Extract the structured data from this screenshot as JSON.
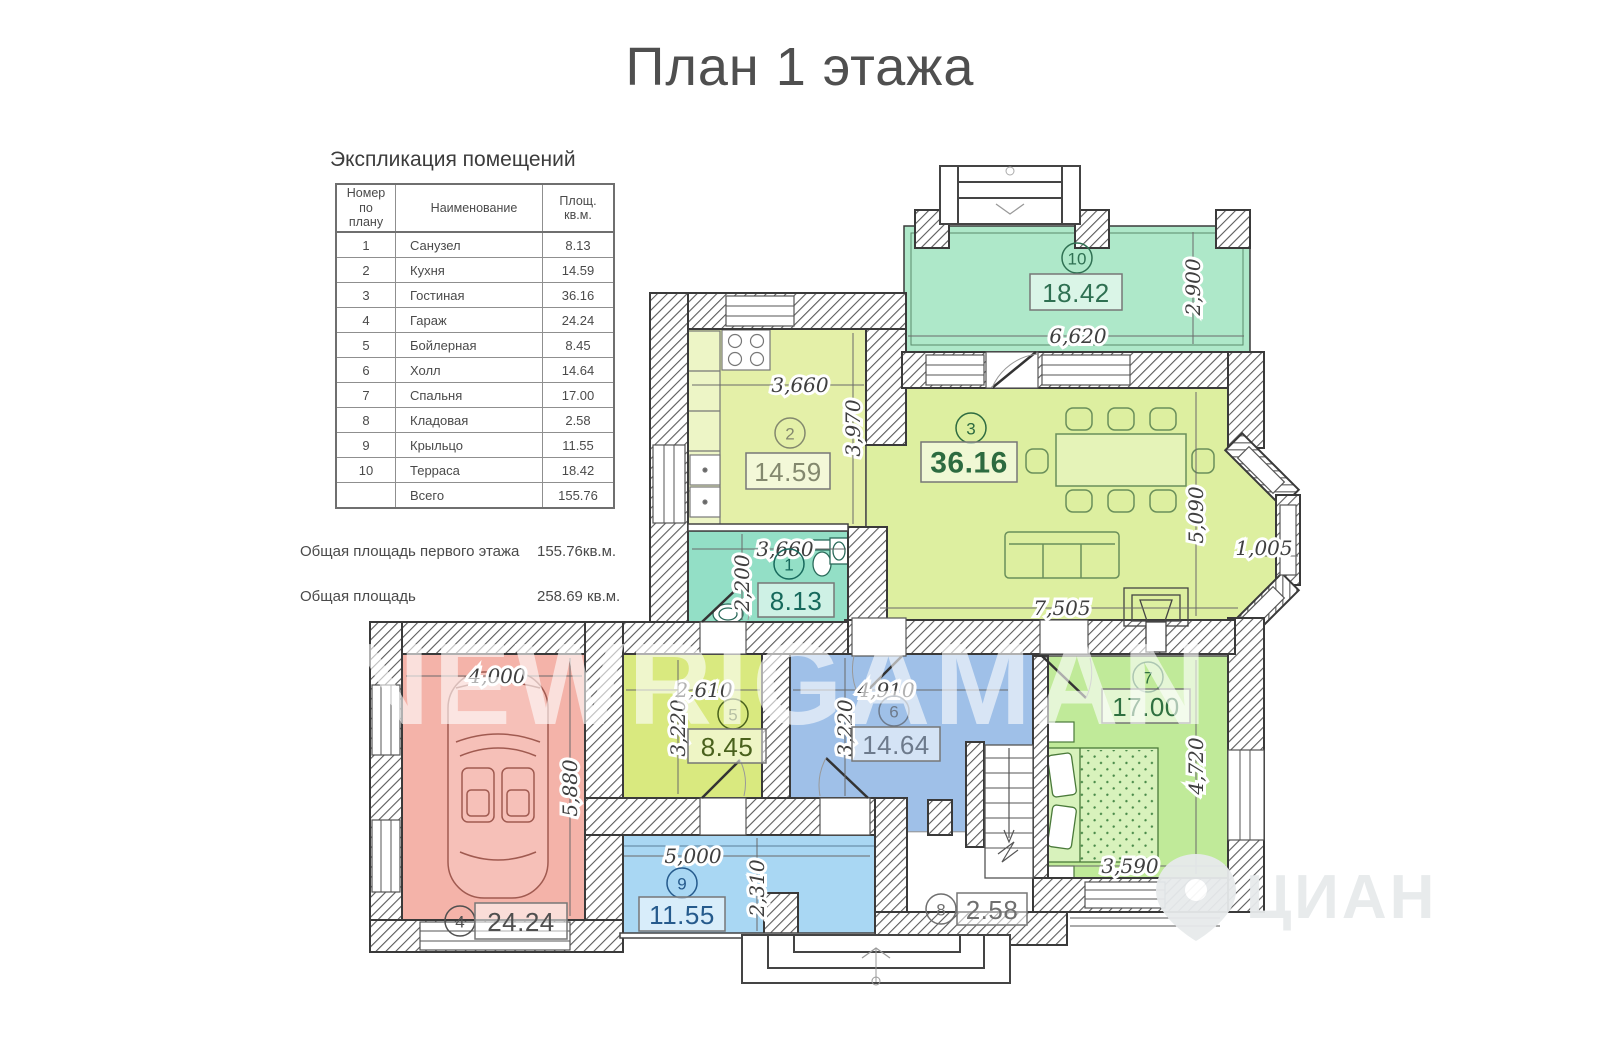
{
  "title": "План 1 этажа",
  "explication": {
    "heading": "Экспликация помещений",
    "columns": [
      "Номер по плану",
      "Наименование",
      "Площ. кв.м."
    ],
    "rows": [
      {
        "num": "1",
        "name": "Санузел",
        "area": "8.13"
      },
      {
        "num": "2",
        "name": "Кухня",
        "area": "14.59"
      },
      {
        "num": "3",
        "name": "Гостиная",
        "area": "36.16"
      },
      {
        "num": "4",
        "name": "Гараж",
        "area": "24.24"
      },
      {
        "num": "5",
        "name": "Бойлерная",
        "area": "8.45"
      },
      {
        "num": "6",
        "name": "Холл",
        "area": "14.64"
      },
      {
        "num": "7",
        "name": "Спальня",
        "area": "17.00"
      },
      {
        "num": "8",
        "name": "Кладовая",
        "area": "2.58"
      },
      {
        "num": "9",
        "name": "Крыльцо",
        "area": "11.55"
      },
      {
        "num": "10",
        "name": "Терраса",
        "area": "18.42"
      }
    ],
    "total": {
      "name": "Всего",
      "area": "155.76"
    }
  },
  "summary": [
    {
      "label": "Общая площадь первого этажа",
      "value": "155.76кв.м."
    },
    {
      "label": "Общая площадь",
      "value": "258.69 кв.м."
    }
  ],
  "plan": {
    "rooms": [
      {
        "number": "1",
        "name": "Санузел",
        "area": "8.13",
        "color": "#93dfc6",
        "label_color": "#17695c"
      },
      {
        "number": "2",
        "name": "Кухня",
        "area": "14.59",
        "color": "#e4f0a8",
        "label_color": "#83886e"
      },
      {
        "number": "3",
        "name": "Гостиная",
        "area": "36.16",
        "color": "#ddefa0",
        "label_color": "#2d6b40"
      },
      {
        "number": "4",
        "name": "Гараж",
        "area": "24.24",
        "color": "#f4b3a9",
        "label_color": "#4f4f4f"
      },
      {
        "number": "5",
        "name": "Бойлерная",
        "area": "8.45",
        "color": "#d9e97f",
        "label_color": "#49611c"
      },
      {
        "number": "6",
        "name": "Холл",
        "area": "14.64",
        "color": "#9fc0e8",
        "label_color": "#6d7a8c"
      },
      {
        "number": "7",
        "name": "Спальня",
        "area": "17.00",
        "color": "#c0ea99",
        "label_color": "#2f7040"
      },
      {
        "number": "8",
        "name": "Кладовая",
        "area": "2.58",
        "color": "#ffffff",
        "label_color": "#6f6f6f"
      },
      {
        "number": "9",
        "name": "Крыльцо",
        "area": "11.55",
        "color": "#a9d7f3",
        "label_color": "#255a8c"
      },
      {
        "number": "10",
        "name": "Терраса",
        "area": "18.42",
        "color": "#aee8c9",
        "label_color": "#2f7052"
      }
    ],
    "dimensions": {
      "terrace_w": "6,620",
      "terrace_h": "2,900",
      "kitchen_w": "3,660",
      "kitchen_h": "3,970",
      "bath_w": "3,660",
      "bath_h": "2,200",
      "living_w": "7,505",
      "living_h": "5,090",
      "bay_w": "1,005",
      "boiler_w": "2,610",
      "boiler_h": "3,220",
      "hall_w": "4,910",
      "hall_h": "3,220",
      "garage_w": "4,000",
      "garage_h": "5,880",
      "porch_w": "5,000",
      "porch_h": "2,310",
      "bedroom_w": "3,590",
      "bedroom_h": "4,720"
    }
  },
  "watermark": {
    "text": "NEWRIGAMAN",
    "brand": "ЦИАН"
  }
}
